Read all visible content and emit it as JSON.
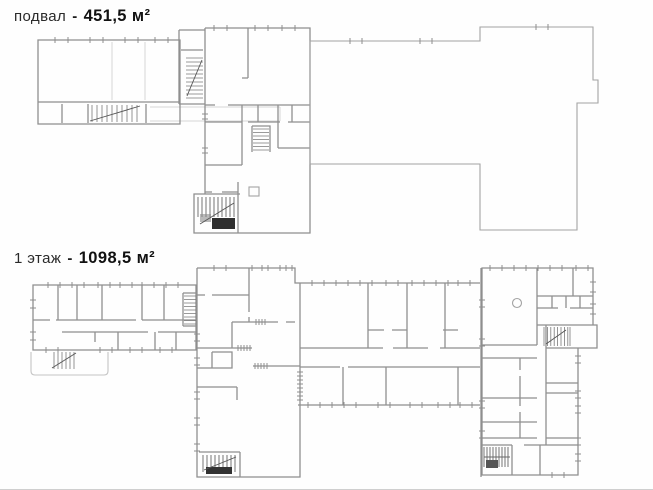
{
  "sheet": {
    "type": "scanned floor plan document",
    "background": "#fefefe",
    "colors": {
      "walls": "#8f8f8f",
      "stair_dark": "#2f2f2f",
      "faint": "#d6d6d6"
    },
    "plans": {
      "basement": {
        "label": "подвал",
        "separator": "-",
        "area": "451,5 м²"
      },
      "first": {
        "label": "1 этаж",
        "separator": "-",
        "area": "1098,5 м²"
      }
    }
  }
}
